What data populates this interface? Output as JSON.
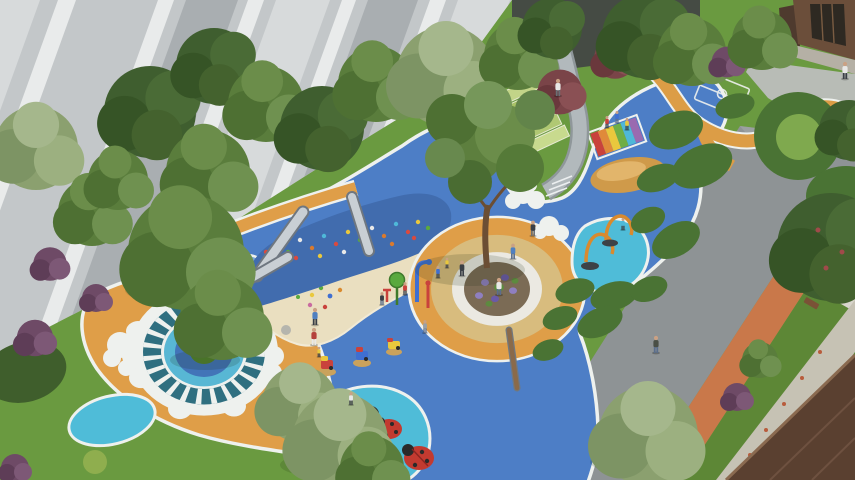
{
  "image": {
    "title": "Children's playground — aerial landscape rendering",
    "type": "3D architectural rendering, bird's-eye view",
    "description": "Aerial rendering of a residential children's playground: blue rubber safety surfacing with white borders, an orange EPDM field with a sun-mosaic circle and light-blue pond motif, a sand pit below a climbing slope with three stainless-steel slides, water-spray posts, a splash pool with orange arch water cannons, ladybug sculptures, spring riders, rainbow climbing steps, a central tree with circular white bench on a tan ring, terraced lawns with a stone footpath, hedges and trees, a grey high-rise facade top-left, a residential entrance building top-right, and a diagonal asphalt road with terracotta jogging track leading past a brown building roof at bottom-right.",
    "people": "adults and children are scattered across the play areas, paths and road"
  },
  "palette": {
    "grass": "#6a9a40",
    "grassDark": "#5d8736",
    "grassLight": "#7fa94e",
    "playBlue": "#4d7ec6",
    "moundBlue": "#416cae",
    "lightBlue": "#7ba7d6",
    "splashTeal": "#4fbcd8",
    "sunTeal": "#2f6f80",
    "playOrange": "#df9e48",
    "ringTan": "#d8bc7e",
    "sand": "#eadfc0",
    "borderWhite": "#eef1ee",
    "road": "#8e9395",
    "track": "#c9784a",
    "pavement": "#b8bcb6",
    "stone": "#b2b9bc",
    "stoneEdge": "#8f979a",
    "bldLight": "#d7dadb",
    "bldMid": "#c3c7c9",
    "bldDark": "#a9aeb1",
    "bldWhite": "#e9ebeb",
    "fence": "#454b44",
    "entryBrown": "#6b4e3a",
    "entryWing": "#4e3a2e",
    "glass": "#2e2922",
    "roof": "#5a4030",
    "walkway": "#c6c2b4",
    "wall": "#d8d5cc",
    "hedge": "#4a7334",
    "hedgeDark": "#3f5e2c",
    "steel": "#c9cfd4",
    "steelDark": "#6f7780",
    "equipRed": "#c9423c",
    "equipYellow": "#e9c83d",
    "equipGreen": "#5aa93e",
    "equipBlue": "#3f6fd1",
    "equipPurple": "#9a6ab0",
    "equipOrange": "#d98a2e",
    "ladybug": "#c23a30",
    "wood": "#8a6a4a",
    "benchWhite": "#ebe9e2",
    "planterSoil": "#7b6b55",
    "flowerPurple": "#8f7fc0"
  },
  "scene": {
    "background": {
      "top_left": "grey high-rise facade with tilted vertical panels",
      "top_center": "dark boundary fence behind trees",
      "top_right": "brown residential entrance building with glass doors and paved apron",
      "bottom_right": "brown pitched building roof beside a light walkway"
    },
    "surfaces": [
      "blue rubber play surface",
      "light-blue splash zones",
      "orange EPDM field",
      "sand pit",
      "lawns",
      "asphalt road",
      "terracotta jogging track",
      "grey stone footpath",
      "orange winding garden path"
    ],
    "equipment": [
      "climbing slope with colored holds",
      "three stainless steel slides",
      "water-spray posts",
      "splash pool with two orange arch cannons",
      "rainbow climbing steps",
      "ladybug sculptures",
      "three spring riders",
      "wooden balance beam",
      "circular tree bench on tan ring",
      "sun-pattern mosaic circle with cloud border",
      "small game-court markings"
    ],
    "vegetation": [
      "street trees along facade",
      "large central tree",
      "round clipped hedges",
      "hedge ring with lawn center",
      "purple and red flowering shrubs",
      "terraced grass mounds"
    ]
  }
}
